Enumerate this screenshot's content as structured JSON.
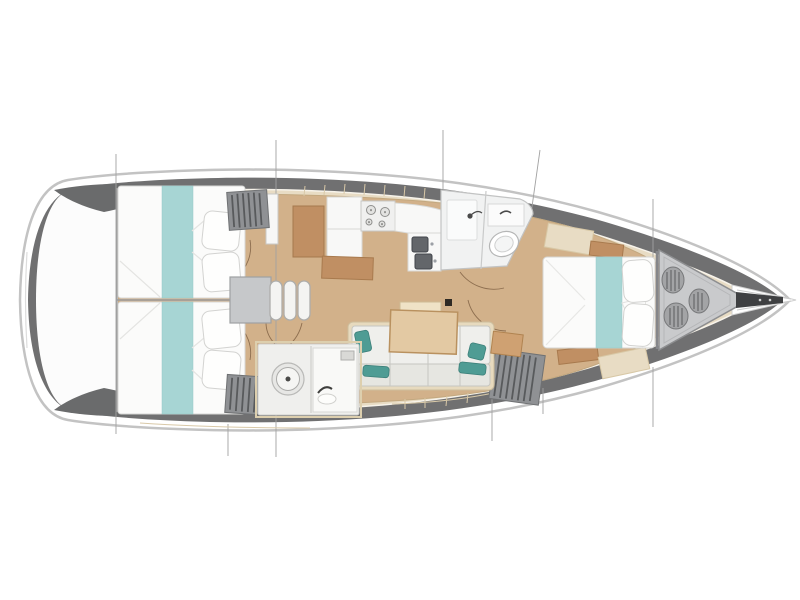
{
  "diagram": {
    "description": "Sailing yacht interior layout floor plan, top view, bow to the right",
    "type": "boat-floorplan"
  },
  "colors": {
    "background": "#ffffff",
    "hull_outline": "#c3c3c3",
    "deck_band": "#707071",
    "side_deck": "#e8dcc4",
    "cabin_floor": "#d2b18a",
    "stern_deck": "#fcfcfc",
    "stern_wedge": "#6a6b6c",
    "bedding_white": "#fbfbfa",
    "bed_runner_teal": "#a7d5d4",
    "pillow_teal": "#4f9c94",
    "wood_furniture": "#c08f63",
    "table_wood": "#e3c9a3",
    "table_leaf": "#efe2c6",
    "locker_gray": "#8f9194",
    "engine_box_gray": "#c6c8ca",
    "step_white": "#f4f4f2",
    "fixture_white": "#f1f2f2",
    "sink_steel": "#63666a",
    "sofa_white": "#efefec",
    "sofa_back": "#e6e6e1",
    "sofa_base": "#e7dabe",
    "cabinet_tan": "#cfa172",
    "anchor_locker": "#c9cacc",
    "rope_coil": "#a3a4a6",
    "bowsprit_dark": "#3f4042",
    "section_line": "#a2a2a2",
    "door_arc": "#8d6e4f",
    "mast_post": "#2f2a24",
    "wall_line": "#9b9b9b",
    "plank_line": "#d9c9a8"
  },
  "parts": [
    "hull",
    "transom-deck",
    "station-lines",
    "aft-berth-port",
    "aft-berth-starboard",
    "companionway-steps",
    "engine-box",
    "hanging-lockers",
    "galley-counter",
    "galley-stove",
    "galley-sinks",
    "forward-head-shower",
    "forward-head-toilet",
    "saloon-settee",
    "saloon-table",
    "mast-post",
    "aft-head-toilet",
    "aft-head-sink",
    "forward-berth",
    "anchor-locker",
    "rope-coils",
    "bowsprit"
  ]
}
